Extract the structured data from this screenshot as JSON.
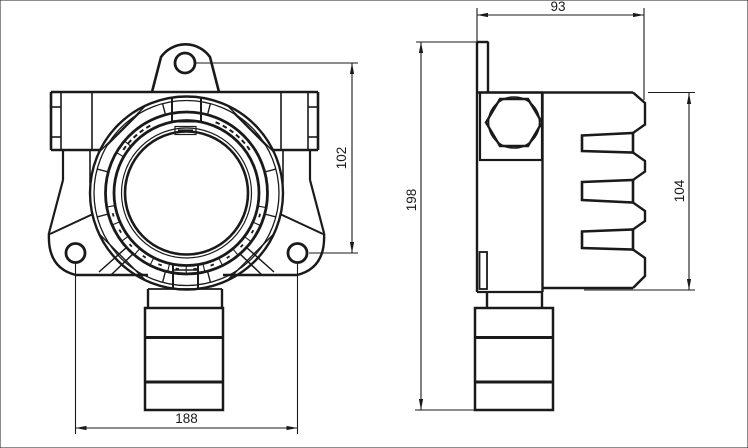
{
  "style": {
    "ink": "#1a1a1a",
    "background": "#ffffff"
  },
  "drawing": {
    "type": "technical-dimension-drawing",
    "views": [
      {
        "id": "front-view",
        "dimensions": [
          {
            "label": "102",
            "orientation": "vertical"
          },
          {
            "label": "188",
            "orientation": "horizontal"
          }
        ]
      },
      {
        "id": "side-view",
        "dimensions": [
          {
            "label": "93",
            "orientation": "horizontal"
          },
          {
            "label": "198",
            "orientation": "vertical"
          },
          {
            "label": "104",
            "orientation": "vertical"
          }
        ]
      }
    ]
  }
}
